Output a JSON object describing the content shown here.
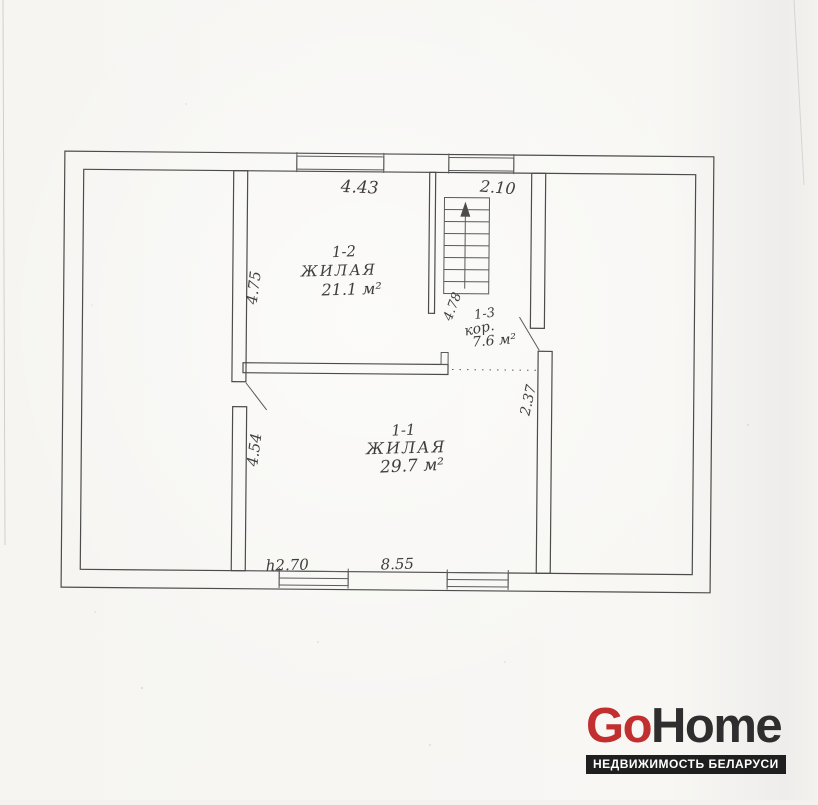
{
  "plan": {
    "ink_color": "#4c4c4c",
    "paper_color": "#f6f5f2",
    "rooms": [
      {
        "number": "1-2",
        "name": "ЖИЛАЯ",
        "area": "21.1 м²"
      },
      {
        "number": "1-1",
        "name": "ЖИЛАЯ",
        "area": "29.7 м²"
      },
      {
        "number": "1-3",
        "name": "кор.",
        "area": "7.6 м²"
      }
    ],
    "dimensions": {
      "room2_width": "4.43",
      "stair_bay_width": "2.10",
      "room2_depth": "4.75",
      "stairs_length": "4.78",
      "room1_left_depth": "4.54",
      "room1_right_depth": "2.37",
      "ceiling_height": "h2.70",
      "room1_width": "8.55"
    }
  },
  "watermark": {
    "brand_primary": "Go",
    "brand_secondary": "Home",
    "brand_primary_color": "#c22f2f",
    "brand_secondary_color": "#2e2e2e",
    "tagline": "НЕДВИЖИМОСТЬ БЕЛАРУСИ",
    "tagline_bg": "#1f1f1f",
    "tagline_color": "#ffffff"
  }
}
